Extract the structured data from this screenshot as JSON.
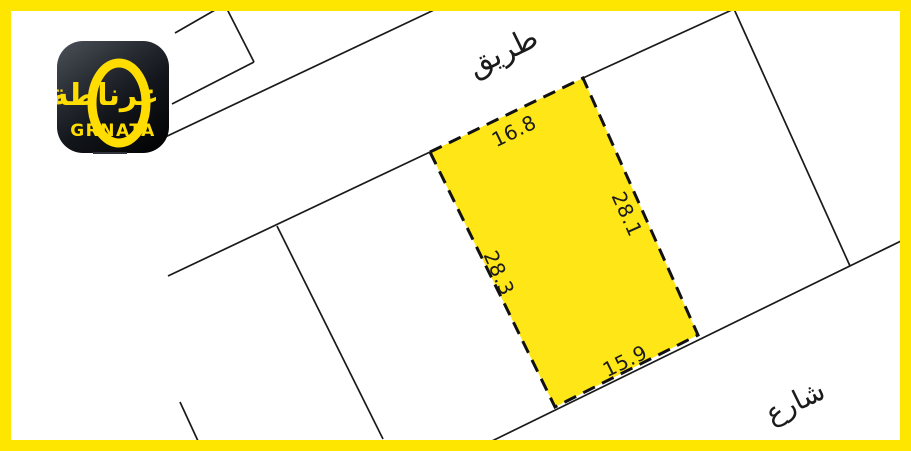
{
  "page": {
    "background_color": "#ffffff",
    "frame_color": "#FFE600",
    "line_color": "#1a1a1a"
  },
  "logo": {
    "brand_arabic": "غرناطة",
    "brand_latin": "GRNATA",
    "background_color": "#101317",
    "accent_color": "#FFDD00"
  },
  "map": {
    "road_label_top": "طريق",
    "road_label_bottom": "شارع",
    "plot": {
      "fill_color": "#FFE617",
      "border_style": "dashed-black",
      "dimensions": {
        "top": "16.8",
        "right": "28.1",
        "left": "28.3",
        "bottom": "15.9"
      }
    }
  }
}
